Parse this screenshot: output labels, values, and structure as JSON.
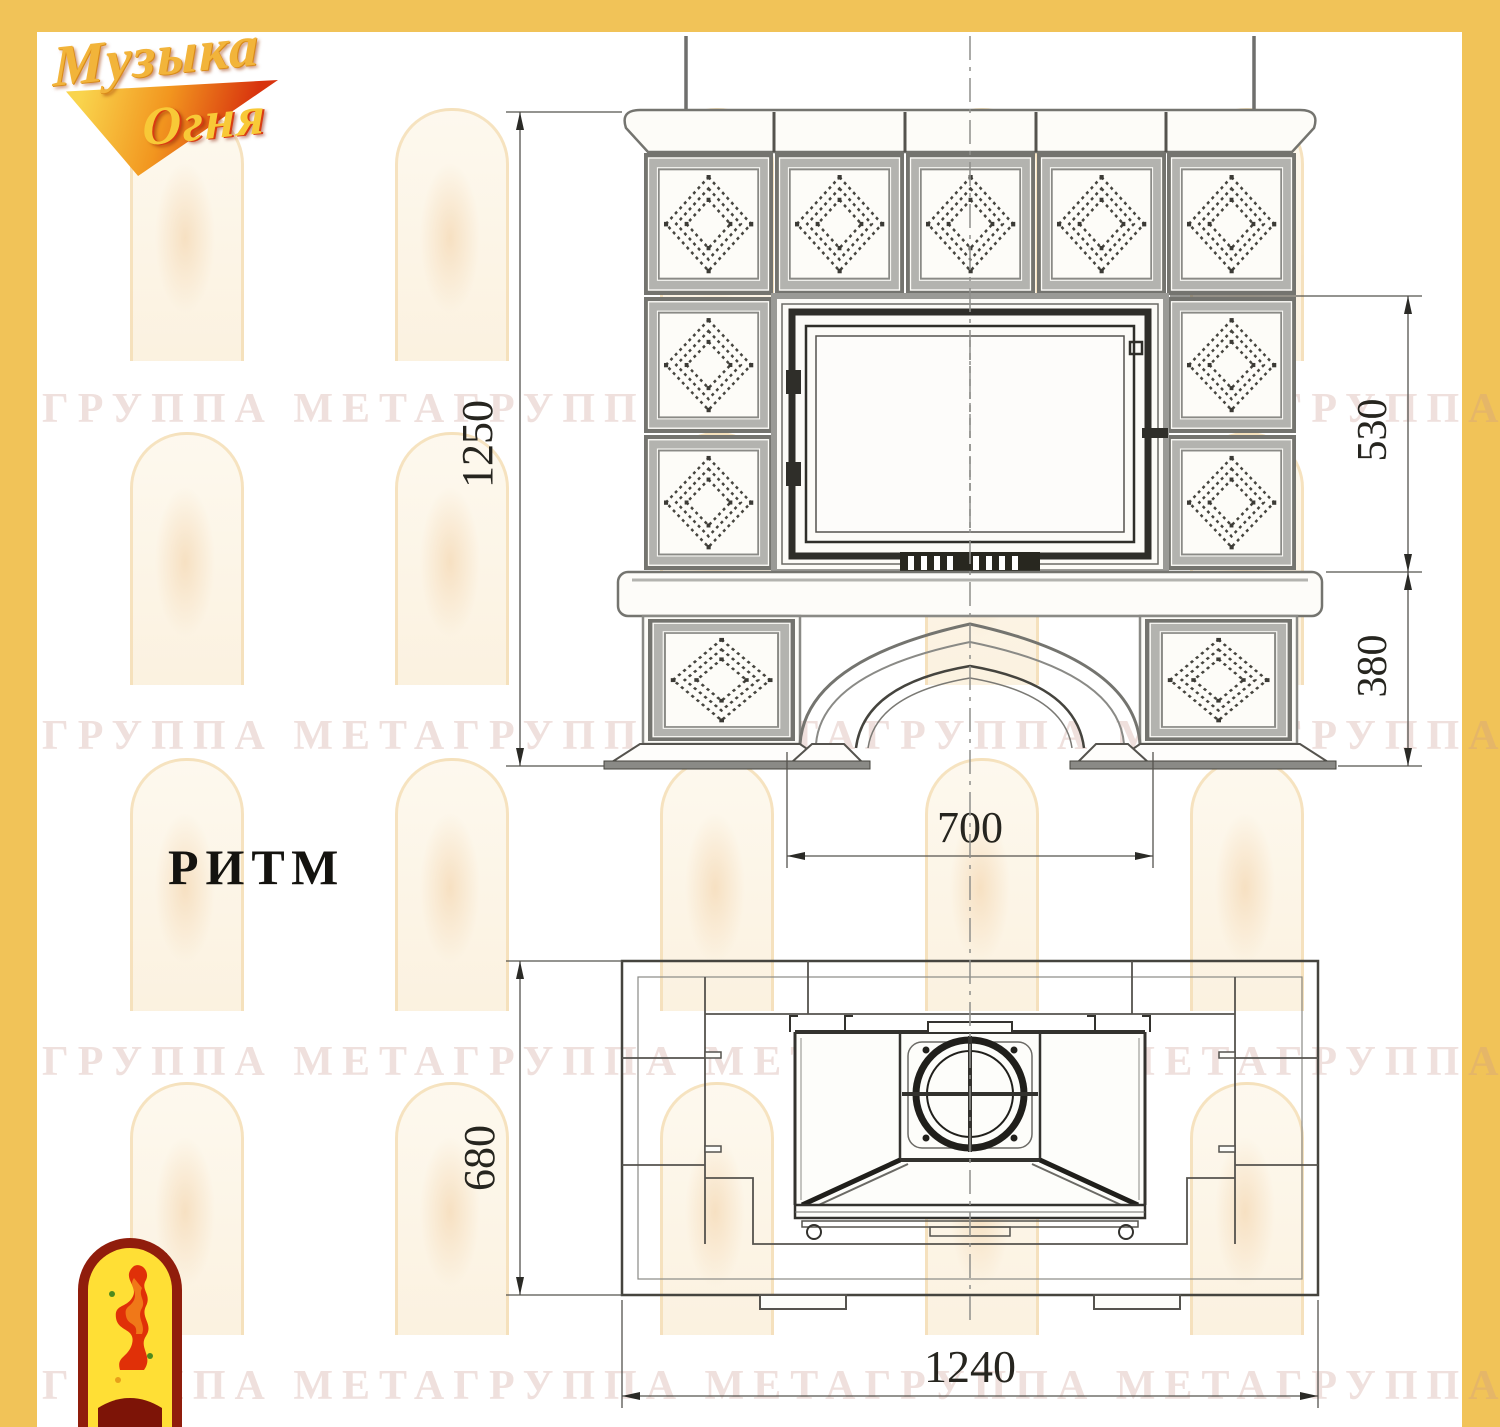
{
  "brand": {
    "line1": "Музыка",
    "line2": "Огня"
  },
  "model": {
    "name": "РИТМ"
  },
  "watermark": {
    "text": "ГРУППА МЕТАГРУППА МЕТАГРУППА МЕТАГРУППА МЕТА"
  },
  "dims": {
    "front_height": "1250",
    "front_firebox": "530",
    "front_base": "380",
    "front_opening": "700",
    "plan_depth": "680",
    "plan_width": "1240"
  },
  "colors": {
    "frame_gold": "#F1C358",
    "logo_gold": "#F2B43A",
    "logo_red": "#D8330E",
    "emblem_border_red": "#901d0c",
    "emblem_yellow": "#FFDF35",
    "drawing_line": "#55534e",
    "watermark_pink": "#CB988E"
  }
}
